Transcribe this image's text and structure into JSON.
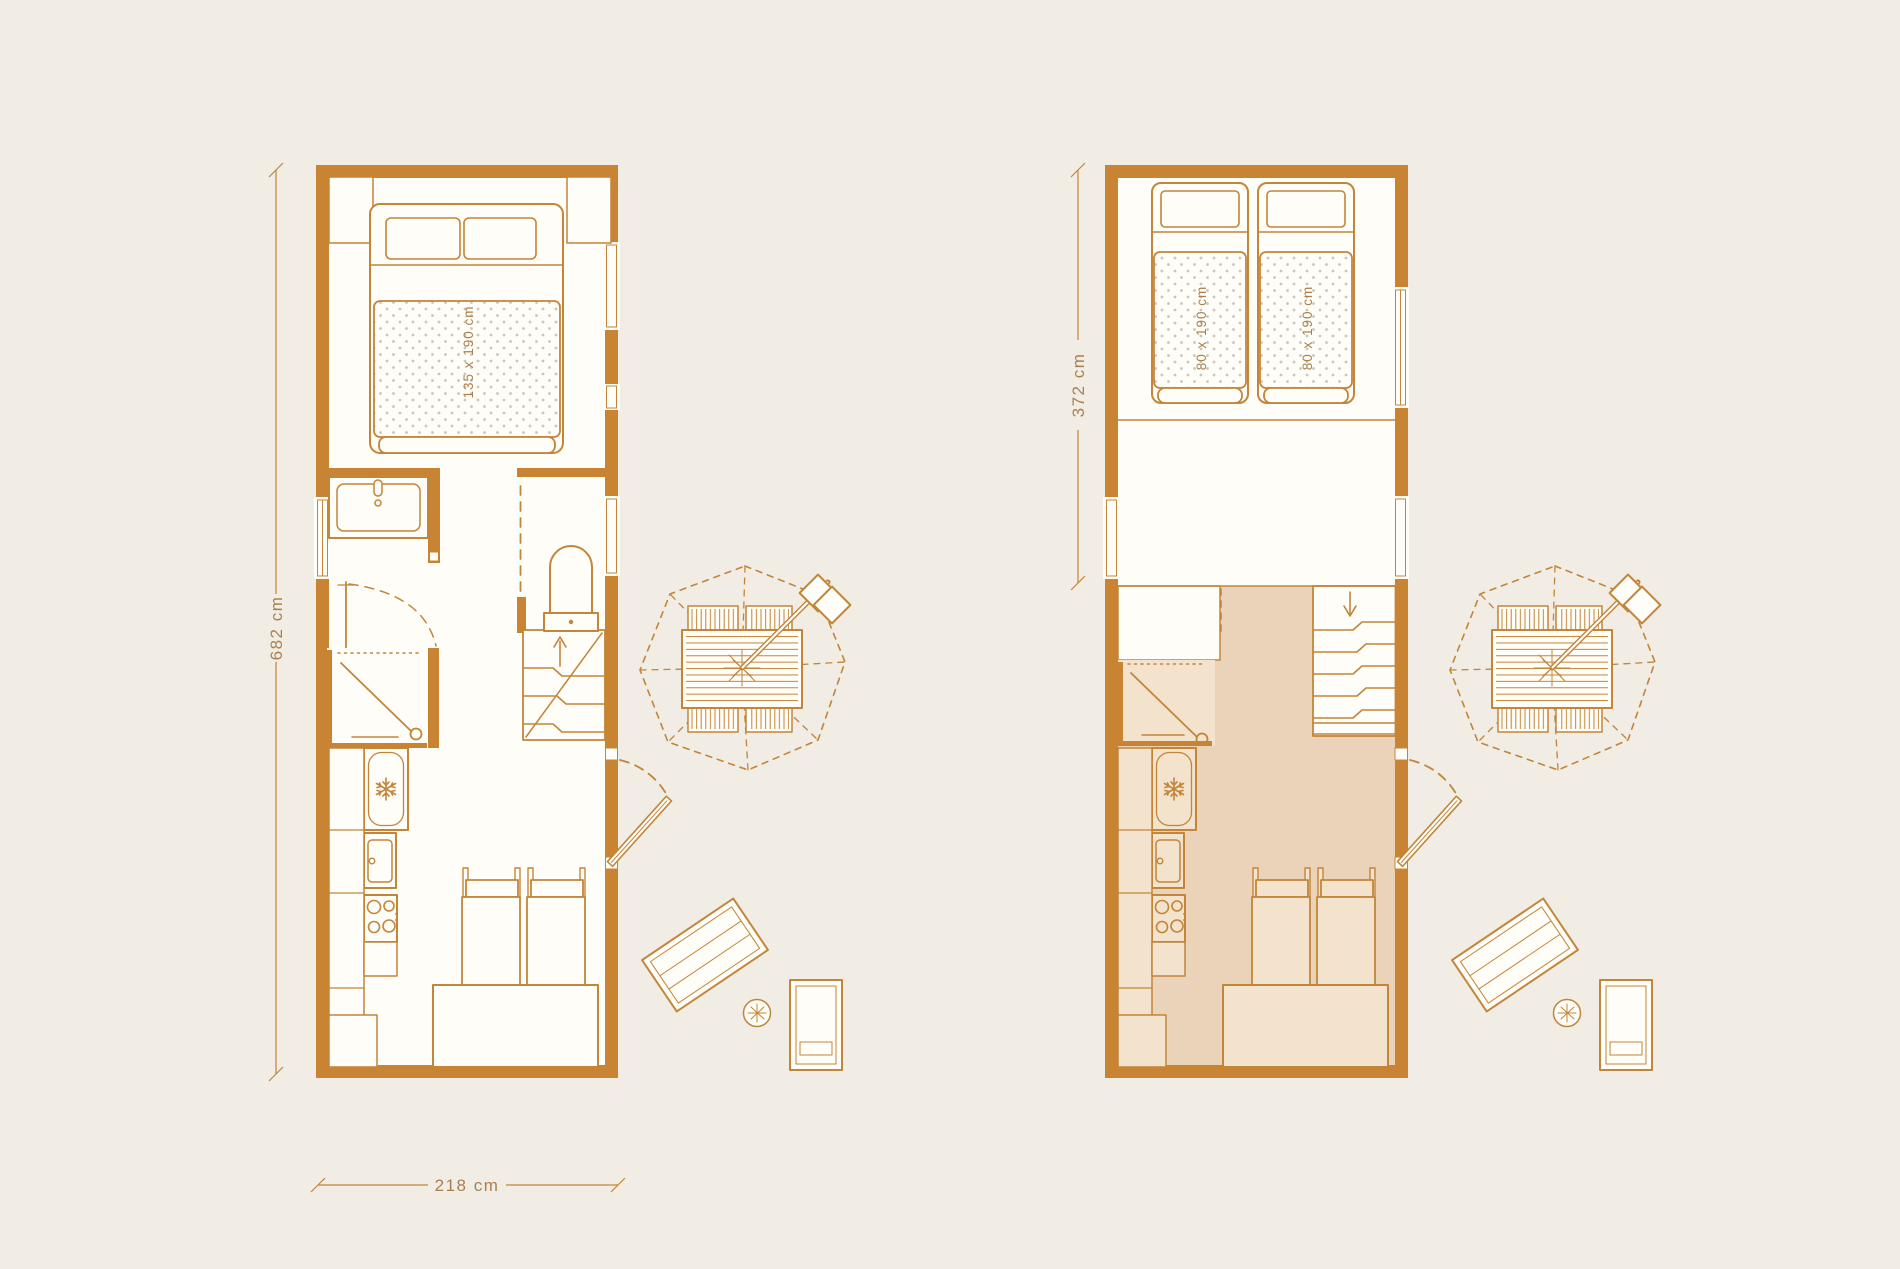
{
  "colors": {
    "background": "#f1ece4",
    "wall": "#c98433",
    "line": "#c28539",
    "interior": "#fffdf8",
    "floor_tint": "#ead3b8",
    "furniture_tint": "#f3e2cc",
    "dimension_text": "#a98050",
    "mattress_dots": "#ccc5b9"
  },
  "plans": {
    "left": {
      "length_label": "682 cm",
      "width_label": "218 cm",
      "bed_label": "135 x 190 cm"
    },
    "right": {
      "length_label": "372 cm",
      "bed_left_label": "80 x 190 cm",
      "bed_right_label": "80 x 190 cm"
    }
  }
}
